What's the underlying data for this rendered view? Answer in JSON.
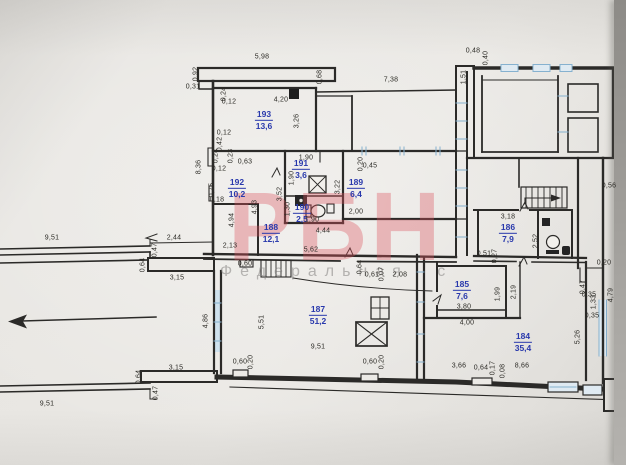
{
  "photo": {
    "type": "scanned floor plan photograph",
    "paper_color": "#e9e7e3",
    "edge_strip_color": "#9b9995",
    "ink_color": "#2b2a28",
    "room_label_color": "#2838ac",
    "window_tint_color": "#86b1cf"
  },
  "watermark": {
    "brand": "РБН",
    "subtitle": "Федеральная с",
    "brand_color": "rgba(219,84,95,0.36)",
    "subtitle_color": "rgba(132,130,128,0.55)"
  },
  "plan": {
    "rooms": [
      {
        "number": "193",
        "area": "13,6",
        "x": 264,
        "y": 120
      },
      {
        "number": "192",
        "area": "10,2",
        "x": 237,
        "y": 188
      },
      {
        "number": "191",
        "area": "3,6",
        "x": 301,
        "y": 169
      },
      {
        "number": "190",
        "area": "2,5",
        "x": 302,
        "y": 213
      },
      {
        "number": "189",
        "area": "6,4",
        "x": 356,
        "y": 188
      },
      {
        "number": "188",
        "area": "12,1",
        "x": 271,
        "y": 233
      },
      {
        "number": "187",
        "area": "51,2",
        "x": 318,
        "y": 315
      },
      {
        "number": "186",
        "area": "7,9",
        "x": 508,
        "y": 233
      },
      {
        "number": "185",
        "area": "7,6",
        "x": 462,
        "y": 290
      },
      {
        "number": "184",
        "area": "35,4",
        "x": 523,
        "y": 342
      }
    ],
    "dimensions": [
      {
        "t": "5,98",
        "x": 262,
        "y": 57
      },
      {
        "t": "0,92",
        "x": 196,
        "y": 74,
        "r": 1
      },
      {
        "t": "0,31",
        "x": 193,
        "y": 87
      },
      {
        "t": "0,24",
        "x": 224,
        "y": 94,
        "r": 1
      },
      {
        "t": "0,12",
        "x": 229,
        "y": 102
      },
      {
        "t": "4,20",
        "x": 281,
        "y": 100
      },
      {
        "t": "3,26",
        "x": 297,
        "y": 121,
        "r": 1
      },
      {
        "t": "0,68",
        "x": 320,
        "y": 77,
        "r": 1
      },
      {
        "t": "7,38",
        "x": 391,
        "y": 80
      },
      {
        "t": "0,48",
        "x": 473,
        "y": 51
      },
      {
        "t": "0,40",
        "x": 486,
        "y": 58,
        "r": 1
      },
      {
        "t": "1,51",
        "x": 464,
        "y": 77,
        "r": 1
      },
      {
        "t": "0,12",
        "x": 224,
        "y": 133
      },
      {
        "t": "0,42",
        "x": 220,
        "y": 144,
        "r": 1
      },
      {
        "t": "8,36",
        "x": 199,
        "y": 167,
        "r": 1
      },
      {
        "t": "0,24",
        "x": 216,
        "y": 156,
        "r": 1
      },
      {
        "t": "0,23",
        "x": 231,
        "y": 156,
        "r": 1
      },
      {
        "t": "0,63",
        "x": 245,
        "y": 162
      },
      {
        "t": "0,12",
        "x": 219,
        "y": 169
      },
      {
        "t": "0,75",
        "x": 212,
        "y": 190,
        "r": 1
      },
      {
        "t": "0,18",
        "x": 217,
        "y": 200
      },
      {
        "t": "4,94",
        "x": 232,
        "y": 220,
        "r": 1
      },
      {
        "t": "3,52",
        "x": 280,
        "y": 194,
        "r": 1
      },
      {
        "t": "4,93",
        "x": 255,
        "y": 207,
        "r": 1
      },
      {
        "t": "1,90",
        "x": 306,
        "y": 158
      },
      {
        "t": "1,90",
        "x": 292,
        "y": 178,
        "r": 1
      },
      {
        "t": "1,30",
        "x": 288,
        "y": 209,
        "r": 1
      },
      {
        "t": "1,90",
        "x": 312,
        "y": 220
      },
      {
        "t": "3,22",
        "x": 338,
        "y": 187,
        "r": 1
      },
      {
        "t": "0,20",
        "x": 361,
        "y": 164,
        "r": 1
      },
      {
        "t": "0,45",
        "x": 370,
        "y": 166
      },
      {
        "t": "2,00",
        "x": 356,
        "y": 212
      },
      {
        "t": "4,44",
        "x": 323,
        "y": 231
      },
      {
        "t": "2,13",
        "x": 230,
        "y": 246
      },
      {
        "t": "5,62",
        "x": 311,
        "y": 250
      },
      {
        "t": "0,60",
        "x": 245,
        "y": 264
      },
      {
        "t": "0,64",
        "x": 360,
        "y": 267,
        "r": 1
      },
      {
        "t": "0,61",
        "x": 372,
        "y": 275
      },
      {
        "t": "0,07",
        "x": 382,
        "y": 274,
        "r": 1
      },
      {
        "t": "2,08",
        "x": 400,
        "y": 275
      },
      {
        "t": "3,18",
        "x": 508,
        "y": 217
      },
      {
        "t": "2,52",
        "x": 536,
        "y": 241,
        "r": 1
      },
      {
        "t": "0,51",
        "x": 484,
        "y": 254
      },
      {
        "t": "0,27",
        "x": 495,
        "y": 256,
        "r": 1
      },
      {
        "t": "0,56",
        "x": 609,
        "y": 186
      },
      {
        "t": "0,20",
        "x": 604,
        "y": 263
      },
      {
        "t": "1,99",
        "x": 498,
        "y": 294,
        "r": 1
      },
      {
        "t": "2,19",
        "x": 514,
        "y": 292,
        "r": 1
      },
      {
        "t": "3,80",
        "x": 464,
        "y": 307
      },
      {
        "t": "4,00",
        "x": 467,
        "y": 323
      },
      {
        "t": "0,47",
        "x": 583,
        "y": 287,
        "r": 1
      },
      {
        "t": "0,35",
        "x": 589,
        "y": 295
      },
      {
        "t": "1,33",
        "x": 594,
        "y": 302,
        "r": 1
      },
      {
        "t": "4,79",
        "x": 611,
        "y": 295,
        "r": 1
      },
      {
        "t": "0,35",
        "x": 592,
        "y": 316
      },
      {
        "t": "5,26",
        "x": 578,
        "y": 337,
        "r": 1
      },
      {
        "t": "9,51",
        "x": 318,
        "y": 347
      },
      {
        "t": "5,51",
        "x": 262,
        "y": 322,
        "r": 1
      },
      {
        "t": "4,86",
        "x": 206,
        "y": 321,
        "r": 1
      },
      {
        "t": "3,66",
        "x": 459,
        "y": 366
      },
      {
        "t": "0,64",
        "x": 481,
        "y": 368
      },
      {
        "t": "0,17",
        "x": 493,
        "y": 368,
        "r": 1
      },
      {
        "t": "0,08",
        "x": 503,
        "y": 371,
        "r": 1
      },
      {
        "t": "8,66",
        "x": 522,
        "y": 366
      },
      {
        "t": "0,60",
        "x": 240,
        "y": 362
      },
      {
        "t": "0,20",
        "x": 251,
        "y": 362,
        "r": 1
      },
      {
        "t": "0,60",
        "x": 370,
        "y": 362
      },
      {
        "t": "0,20",
        "x": 382,
        "y": 362,
        "r": 1
      },
      {
        "t": "9,51",
        "x": 52,
        "y": 238
      },
      {
        "t": "2,44",
        "x": 174,
        "y": 238
      },
      {
        "t": "0,47",
        "x": 155,
        "y": 250,
        "r": 1
      },
      {
        "t": "0,64",
        "x": 143,
        "y": 265,
        "r": 1
      },
      {
        "t": "3,15",
        "x": 177,
        "y": 278
      },
      {
        "t": "3,15",
        "x": 176,
        "y": 368
      },
      {
        "t": "0,64",
        "x": 139,
        "y": 377,
        "r": 1
      },
      {
        "t": "0,47",
        "x": 156,
        "y": 393,
        "r": 1
      },
      {
        "t": "9,51",
        "x": 47,
        "y": 404
      }
    ],
    "icons": [
      {
        "name": "direction-arrow",
        "x": 85,
        "y": 319
      },
      {
        "name": "balcony-slab",
        "x": 266,
        "y": 74
      },
      {
        "name": "electrical-panel-icon",
        "x": 294,
        "y": 94
      },
      {
        "name": "shower-tray-icon",
        "x": 317,
        "y": 184
      },
      {
        "name": "washing-machine-icon",
        "x": 301,
        "y": 200
      },
      {
        "name": "toilet-icon",
        "x": 315,
        "y": 211
      },
      {
        "name": "sink-icon",
        "x": 330,
        "y": 208
      },
      {
        "name": "stairs-icon-lower",
        "x": 276,
        "y": 268
      },
      {
        "name": "stairs-icon-upper",
        "x": 544,
        "y": 197
      },
      {
        "name": "stairs-direction-arrow",
        "x": 541,
        "y": 200
      },
      {
        "name": "wc-toilet-icon",
        "x": 553,
        "y": 244
      },
      {
        "name": "wc-sink-icon",
        "x": 566,
        "y": 250
      },
      {
        "name": "wc-vent-icon",
        "x": 546,
        "y": 222
      },
      {
        "name": "shaft-cross-icon",
        "x": 371,
        "y": 334
      },
      {
        "name": "vent-grid-icon",
        "x": 380,
        "y": 308
      },
      {
        "name": "door-swing-mark",
        "x": 276,
        "y": 172
      },
      {
        "name": "window-opening",
        "x": 218,
        "y": 320
      }
    ]
  }
}
